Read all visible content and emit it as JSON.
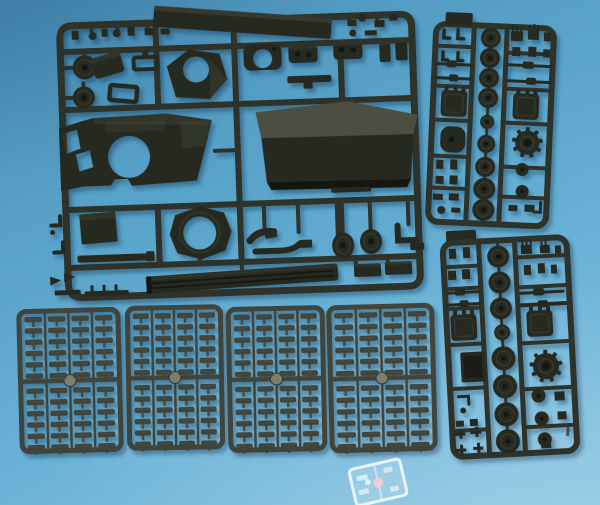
{
  "scene": {
    "subject": "Photograph of dark green-grey injection-molded model tank kit sprues laid on a light blue cloth",
    "colors": {
      "bg1": "#4a8fb8",
      "bg2": "#58a3c9",
      "bg3": "#68b1d6",
      "bg4": "#85c2e1",
      "plastic": "#262920",
      "plastic_highlight": "#4b4e40",
      "plastic_shadow": "#14160f",
      "runner": "#2f3228",
      "track_link": "#41443a",
      "center_boss": "#7b7f72",
      "clear_stroke": "#e9f4f9",
      "clear_fill": "rgba(219,239,248,0.22)",
      "clear_glint": "#f2ccd2"
    },
    "sprue_count": 8
  },
  "sprues": {
    "hull": {
      "name": "hull-and-fittings-sprue",
      "parts": [
        "hull roof plate",
        "casemate box",
        "casemate front plate with gun opening",
        "turret shell",
        "round hatches",
        "cupola ring",
        "fuel drums",
        "turret ring",
        "access panel",
        "fender strips",
        "exhaust pipes",
        "idler wheels",
        "bracket",
        "small fittings"
      ]
    },
    "wheels_upper": {
      "name": "running-gear-sprue-upper",
      "wheel_column_x": 487,
      "wheels": [
        [
          38,
          10
        ],
        [
          58,
          10
        ],
        [
          78,
          10
        ],
        [
          98,
          10
        ],
        [
          122,
          7
        ],
        [
          144,
          9
        ],
        [
          167,
          10
        ],
        [
          189,
          11
        ],
        [
          210,
          11
        ]
      ],
      "rollers": [
        [
          524,
          168,
          6.5
        ],
        [
          525,
          190,
          6.5
        ]
      ],
      "sprocket": {
        "cx": 528,
        "cy": 141,
        "r": 12
      }
    },
    "wheels_lower": {
      "name": "running-gear-sprue-lower",
      "wheel_column_x": 503,
      "wheels": [
        [
          256,
          11
        ],
        [
          282,
          11
        ],
        [
          308,
          11
        ],
        [
          332,
          8
        ],
        [
          358,
          12
        ],
        [
          386,
          12
        ],
        [
          414,
          12
        ],
        [
          441,
          12
        ]
      ],
      "rollers": [
        [
          536,
          397,
          7
        ],
        [
          538,
          420,
          7
        ],
        [
          540,
          441,
          7
        ]
      ],
      "sprocket": {
        "cx": 545,
        "cy": 368,
        "r": 13
      }
    },
    "tracks": {
      "name": "track-link-sprues",
      "count": 4,
      "columns": 4,
      "rows_per_column": 12
    },
    "clear": {
      "name": "clear-parts-sprue",
      "part_count": 6
    }
  }
}
